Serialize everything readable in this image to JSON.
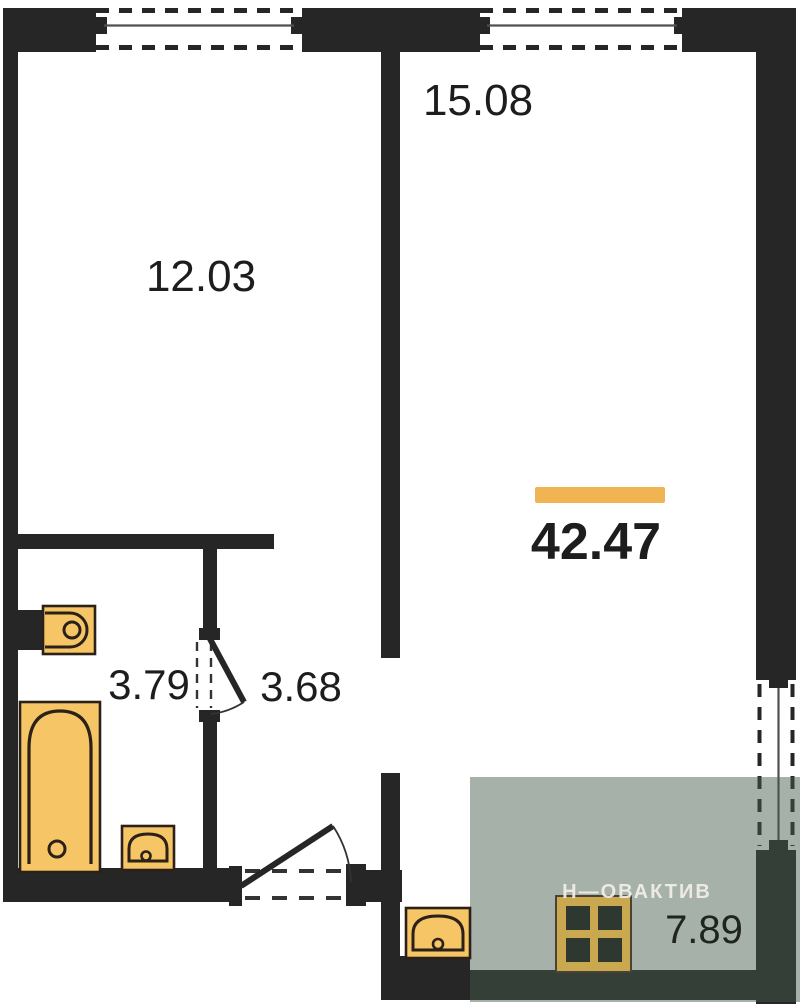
{
  "plan": {
    "type": "apartment-floor-plan",
    "rooms": [
      {
        "id": "room-left",
        "area": "12.03"
      },
      {
        "id": "room-right",
        "area": "15.08"
      },
      {
        "id": "bathroom",
        "area": "3.79"
      },
      {
        "id": "hallway",
        "area": "3.68"
      },
      {
        "id": "total",
        "area": "42.47"
      },
      {
        "id": "balcony",
        "area": "7.89"
      }
    ],
    "watermark": "Н—ОВАКТИВ",
    "fixtures": [
      "toilet-icon",
      "bathtub-icon",
      "bath-sink-icon",
      "kitchen-sink-icon",
      "stove-icon"
    ],
    "colors": {
      "wall": "#262626",
      "window_line": "#4f4f4f",
      "accent_bar": "#f0b452",
      "fixture_fill": "#f6c566",
      "fixture_outline": "#2b2118",
      "balcony_overlay": "rgba(70,92,76,0.48)",
      "stove_fill": "#c9a84f",
      "stove_burner": "#2e3831",
      "label": "#1d1d1d",
      "watermark_color": "#f2efe7"
    }
  }
}
